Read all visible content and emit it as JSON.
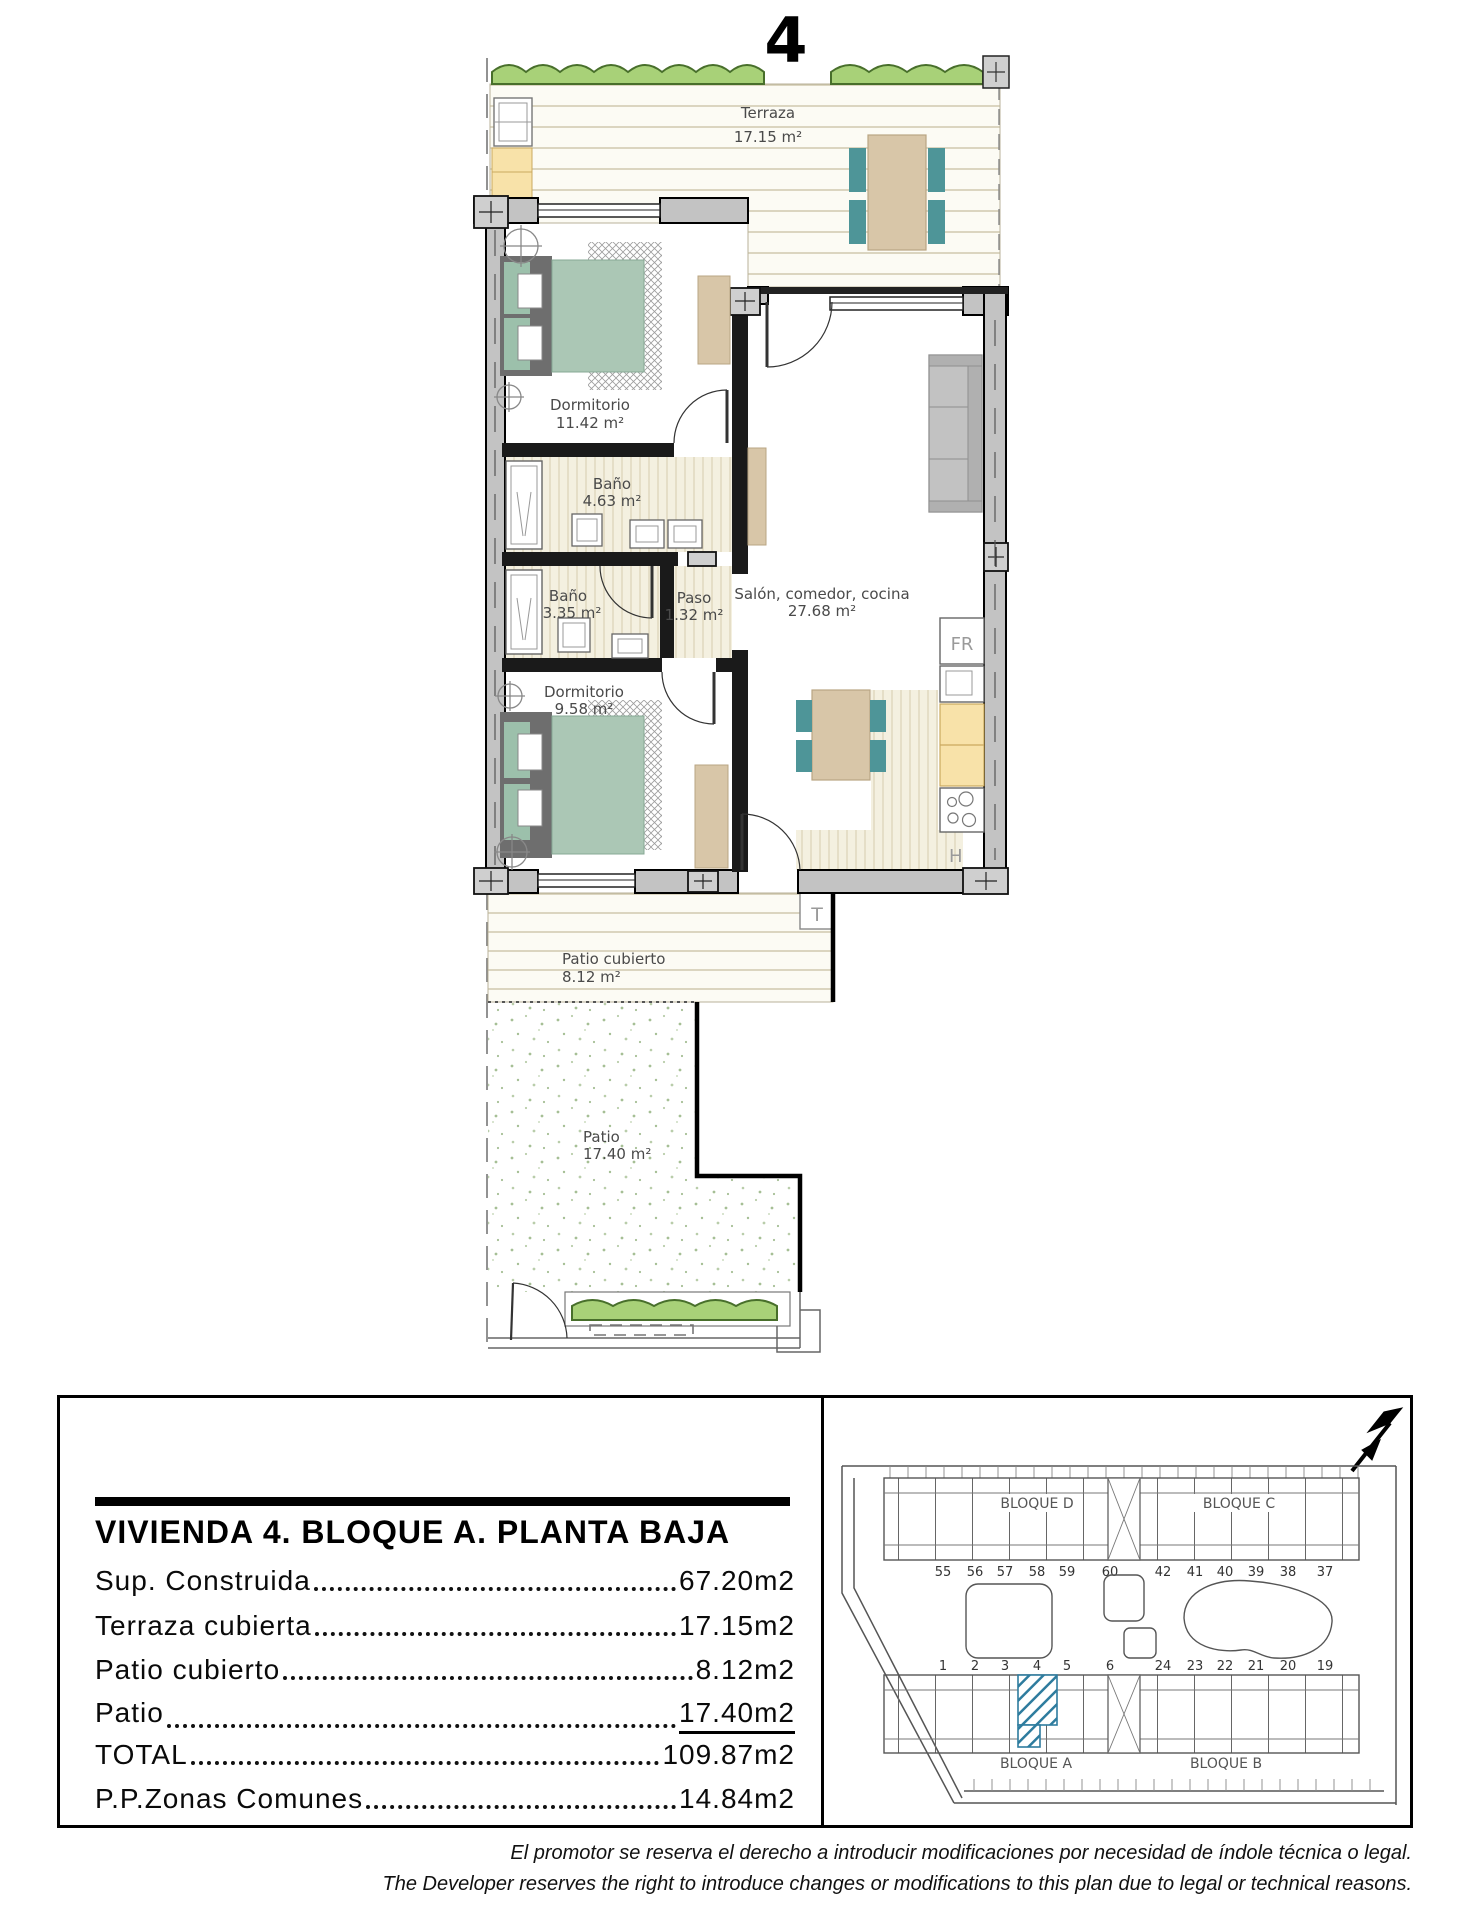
{
  "plan": {
    "unit_number": "4",
    "rooms": {
      "terraza": {
        "name": "Terraza",
        "area": "17.15 m²"
      },
      "dormitorio1": {
        "name": "Dormitorio",
        "area": "11.42 m²"
      },
      "bano1": {
        "name": "Baño",
        "area": "4.63 m²"
      },
      "bano2": {
        "name": "Baño",
        "area": "3.35 m²"
      },
      "paso": {
        "name": "Paso",
        "area": "1.32 m²"
      },
      "salon": {
        "name": "Salón, comedor, cocina",
        "area": "27.68 m²"
      },
      "dormitorio2": {
        "name": "Dormitorio",
        "area": "9.58 m²"
      },
      "patio_cubierto": {
        "name": "Patio cubierto",
        "area": "8.12 m²"
      },
      "patio": {
        "name": "Patio",
        "area": "17.40 m²"
      }
    },
    "appliances": {
      "fridge": "FR",
      "hob": "H",
      "tank": "T"
    }
  },
  "info": {
    "title": "VIVIENDA 4. BLOQUE A. PLANTA BAJA",
    "rows": [
      {
        "label": "Sup. Construida",
        "value": "67.20m2"
      },
      {
        "label": "Terraza cubierta",
        "value": "17.15m2"
      },
      {
        "label": "Patio cubierto",
        "value": "8.12m2"
      },
      {
        "label": "Patio",
        "value": "17.40m2"
      },
      {
        "label": "TOTAL",
        "value": "109.87m2"
      },
      {
        "label": "P.P.Zonas Comunes",
        "value": "14.84m2"
      }
    ]
  },
  "siteplan": {
    "block_d": "BLOQUE D",
    "block_c": "BLOQUE C",
    "block_a": "BLOQUE A",
    "block_b": "BLOQUE B",
    "top_numbers": [
      "55",
      "56",
      "57",
      "58",
      "59",
      "60",
      "42",
      "41",
      "40",
      "39",
      "38",
      "37"
    ],
    "bottom_numbers": [
      "1",
      "2",
      "3",
      "4",
      "5",
      "6",
      "24",
      "23",
      "22",
      "21",
      "20",
      "19"
    ],
    "highlight_color": "#2e7c9e"
  },
  "colors": {
    "hedge": "#a8d178",
    "wall": "#c3c3c3",
    "bed": "#abc7b5",
    "furniture_tan": "#d8c6a8",
    "chair_teal": "#4e9598",
    "counter_yellow": "#f8e2a9"
  },
  "disclaimer": {
    "line1": "El promotor se reserva el derecho a introducir modificaciones por necesidad de índole técnica o legal.",
    "line2": "The Developer reserves the right to introduce changes or modifications to this plan due to legal or technical reasons."
  }
}
